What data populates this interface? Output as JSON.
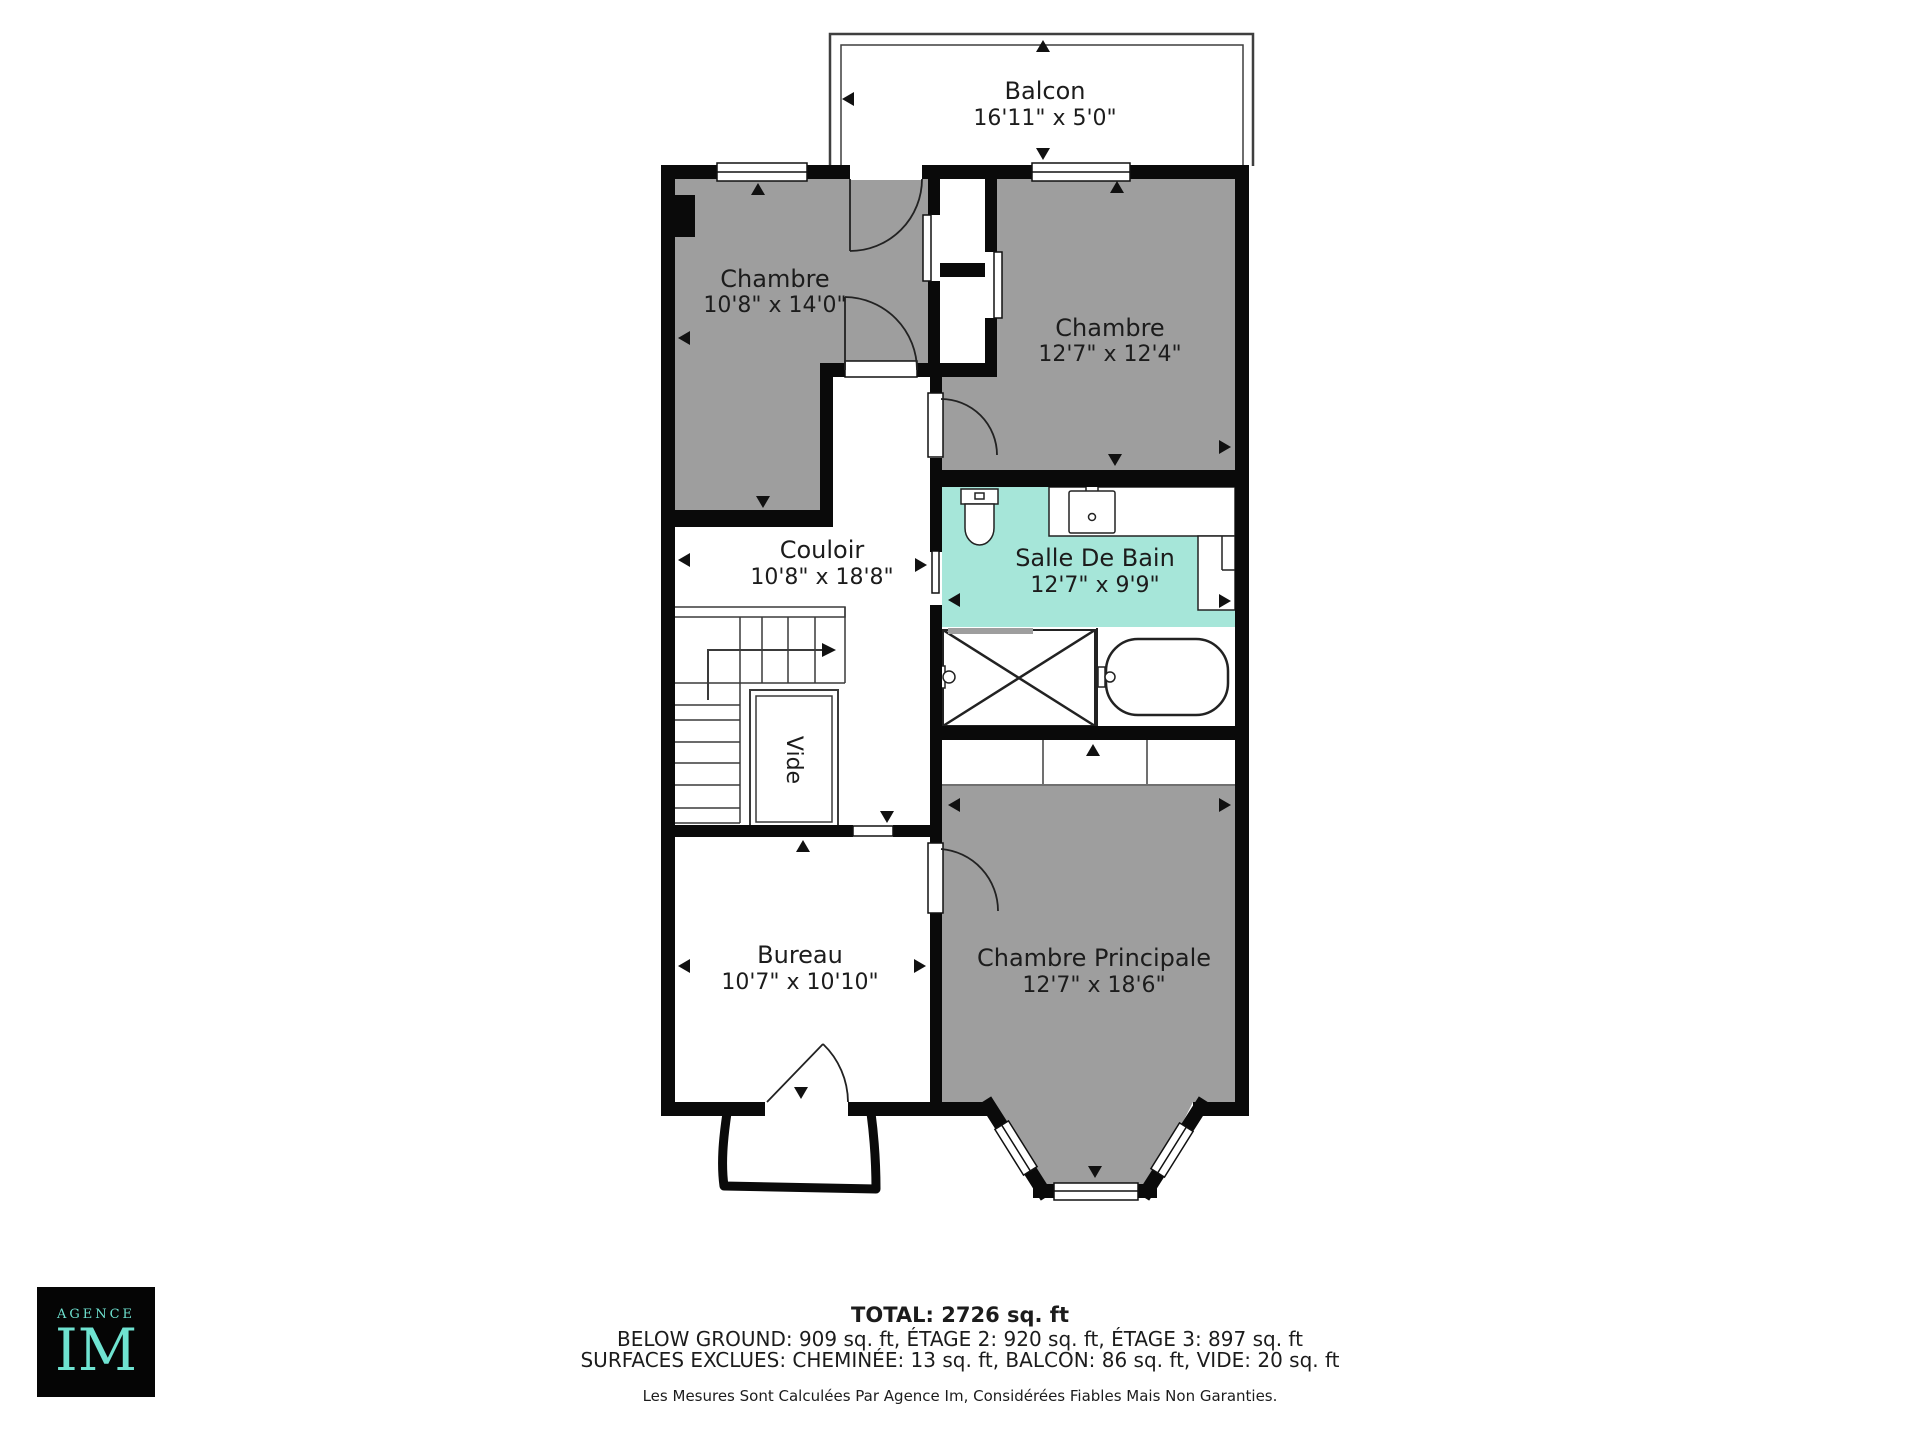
{
  "plan": {
    "rooms": [
      {
        "name": "Balcon",
        "dims": "16'11\" x 5'0\""
      },
      {
        "name": "Chambre",
        "dims": "10'8\" x 14'0\""
      },
      {
        "name": "Chambre",
        "dims": "12'7\" x 12'4\""
      },
      {
        "name": "Couloir",
        "dims": "10'8\" x 18'8\""
      },
      {
        "name": "Salle De Bain",
        "dims": "12'7\" x 9'9\""
      },
      {
        "name": "Vide",
        "dims": ""
      },
      {
        "name": "Bureau",
        "dims": "10'7\" x 10'10\""
      },
      {
        "name": "Chambre Principale",
        "dims": "12'7\" x 18'6\""
      }
    ],
    "colors": {
      "room_gray": "#9e9e9e",
      "bathroom_teal": "#a6e6d9",
      "wall_black": "#0a0a0a",
      "logo_teal": "#6fe3d1"
    }
  },
  "summary": {
    "total": "TOTAL: 2726 sq. ft",
    "areas": "BELOW GROUND: 909 sq. ft, ÉTAGE 2: 920 sq. ft, ÉTAGE 3: 897 sq. ft",
    "exclusions": "SURFACES EXCLUES: CHEMINÉE: 13 sq. ft, BALCON: 86 sq. ft, VIDE: 20 sq. ft",
    "disclaimer": "Les Mesures Sont Calculées Par Agence Im, Considérées Fiables Mais Non Garanties."
  },
  "logo": {
    "top": "AGENCE",
    "main": "IM"
  }
}
